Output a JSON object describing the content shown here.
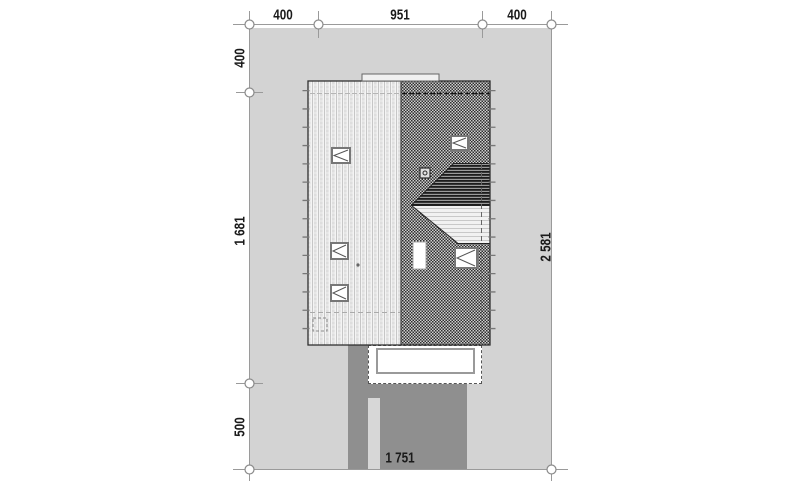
{
  "drawing": {
    "kind": "site-plan-roof-view"
  },
  "dimensions": {
    "top": [
      "400",
      "951",
      "400"
    ],
    "left": [
      "400",
      "1 681",
      "500"
    ],
    "right": [
      "2 581"
    ],
    "bottom": [
      "1 751"
    ]
  },
  "colors": {
    "background": "#ffffff",
    "plot_area": "#d3d3d3",
    "driveway": "#8f8f8f",
    "walkway": "#d7d7d7",
    "terrace": "#ffffff",
    "roof_left_plane": "#e9e9e9",
    "roof_right_plane": "#555555",
    "lower_roof_dark": "#1c1c1c",
    "lower_roof_light": "#f1f1f1",
    "dimension_line": "#9a9a9a",
    "label_text": "#1a1a1a"
  }
}
